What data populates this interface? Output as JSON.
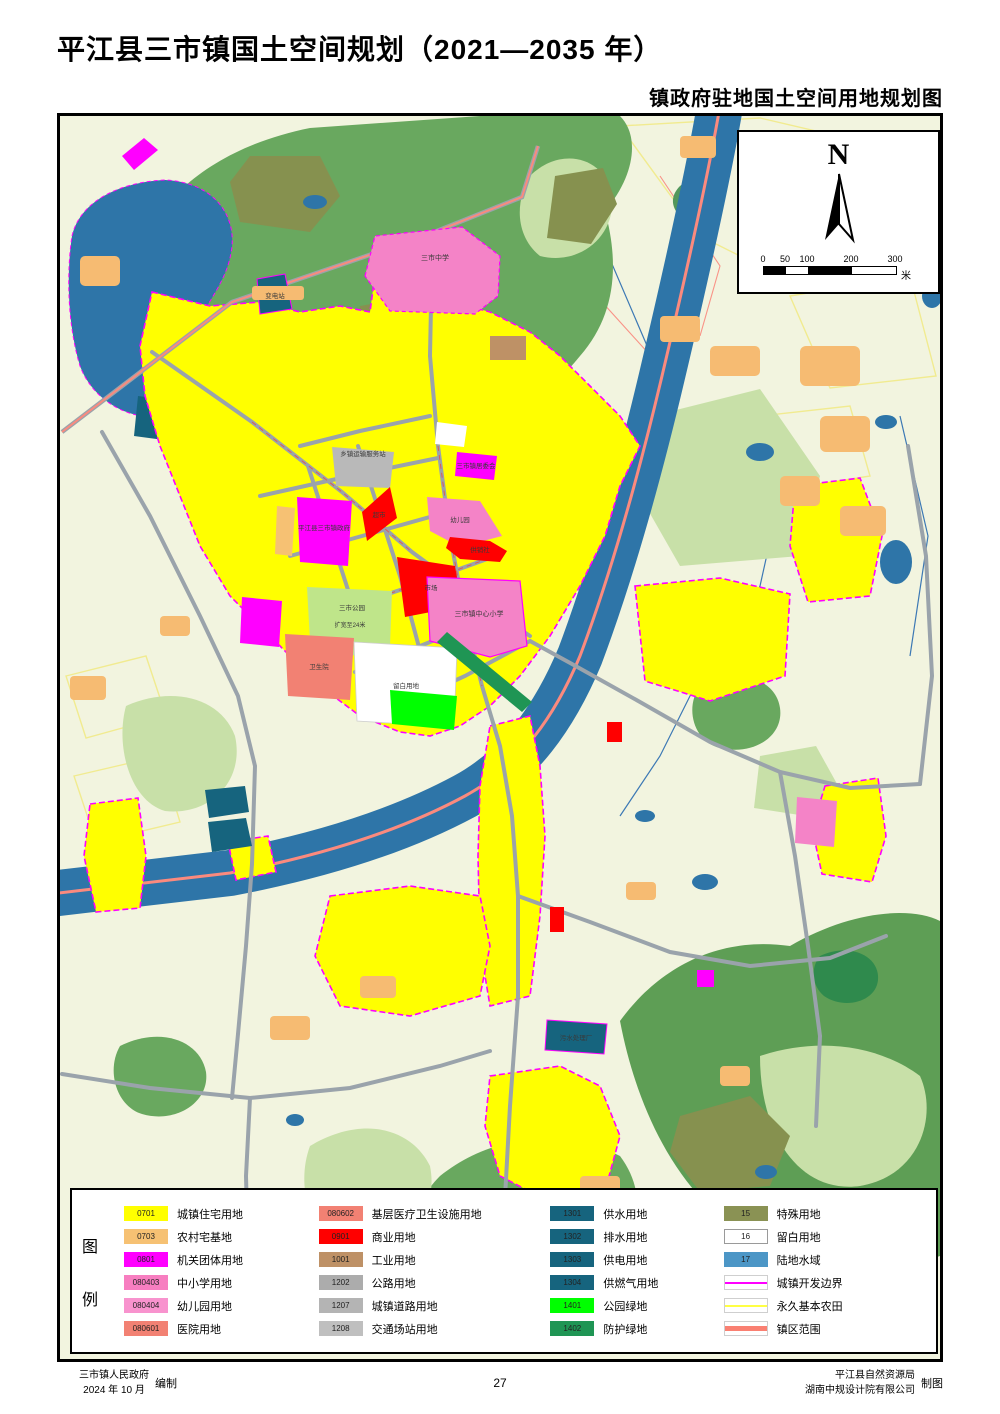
{
  "title": "平江县三市镇国土空间规划（2021—2035 年）",
  "subtitle": "镇政府驻地国土空间用地规划图",
  "map": {
    "north_label": "N",
    "scale": {
      "ticks": [
        "0",
        "50",
        "100",
        "200",
        "300"
      ],
      "tick_pos": [
        0,
        22,
        44,
        88,
        132
      ],
      "unit": "米"
    },
    "labels": [
      {
        "text": "三市中学",
        "x": 375,
        "y": 144,
        "size": 7
      },
      {
        "text": "变电站",
        "x": 215,
        "y": 182,
        "size": 6.5
      },
      {
        "text": "乡镇运输服务站",
        "x": 303,
        "y": 340,
        "size": 6.5
      },
      {
        "text": "三市镇居委会",
        "x": 416,
        "y": 352,
        "size": 6.5
      },
      {
        "text": "超市",
        "x": 319,
        "y": 401,
        "size": 6.5
      },
      {
        "text": "平江县三市镇政府",
        "x": 264,
        "y": 414,
        "size": 6.5
      },
      {
        "text": "幼儿园",
        "x": 400,
        "y": 406,
        "size": 6.5
      },
      {
        "text": "供销社",
        "x": 420,
        "y": 436,
        "size": 6.5
      },
      {
        "text": "市场",
        "x": 371,
        "y": 474,
        "size": 6.5
      },
      {
        "text": "三市公园",
        "x": 292,
        "y": 494,
        "size": 6.5
      },
      {
        "text": "扩宽至24米",
        "x": 290,
        "y": 511,
        "size": 6
      },
      {
        "text": "卫生院",
        "x": 259,
        "y": 553,
        "size": 6.5
      },
      {
        "text": "留白用地",
        "x": 346,
        "y": 572,
        "size": 6.5
      },
      {
        "text": "三市镇中心小学",
        "x": 419,
        "y": 500,
        "size": 7
      },
      {
        "text": "污水处理厂",
        "x": 516,
        "y": 924,
        "size": 6.5
      }
    ]
  },
  "legend": {
    "caption": [
      "图",
      "例"
    ],
    "columns": [
      {
        "items": [
          {
            "code": "0701",
            "label": "城镇住宅用地",
            "color": "#FFFF00"
          },
          {
            "code": "0703",
            "label": "农村宅基地",
            "color": "#F6C173"
          },
          {
            "code": "0801",
            "label": "机关团体用地",
            "color": "#FF00FF"
          },
          {
            "code": "080403",
            "label": "中小学用地",
            "color": "#F77EC0"
          },
          {
            "code": "080404",
            "label": "幼儿园用地",
            "color": "#F893CE"
          },
          {
            "code": "080601",
            "label": "医院用地",
            "color": "#F28173"
          }
        ]
      },
      {
        "items": [
          {
            "code": "080602",
            "label": "基层医疗卫生设施用地",
            "color": "#F28173"
          },
          {
            "code": "0901",
            "label": "商业用地",
            "color": "#FF0000"
          },
          {
            "code": "1001",
            "label": "工业用地",
            "color": "#BE9166"
          },
          {
            "code": "1202",
            "label": "公路用地",
            "color": "#ACACAC"
          },
          {
            "code": "1207",
            "label": "城镇道路用地",
            "color": "#B4B4B4"
          },
          {
            "code": "1208",
            "label": "交通场站用地",
            "color": "#BFBFBF"
          }
        ]
      },
      {
        "items": [
          {
            "code": "1301",
            "label": "供水用地",
            "color": "#16647E"
          },
          {
            "code": "1302",
            "label": "排水用地",
            "color": "#16647E"
          },
          {
            "code": "1303",
            "label": "供电用地",
            "color": "#16647E"
          },
          {
            "code": "1304",
            "label": "供燃气用地",
            "color": "#16647E"
          },
          {
            "code": "1401",
            "label": "公园绿地",
            "color": "#00FF00"
          },
          {
            "code": "1402",
            "label": "防护绿地",
            "color": "#1F9554"
          }
        ]
      },
      {
        "items": [
          {
            "code": "15",
            "label": "特殊用地",
            "color": "#8A9254"
          },
          {
            "code": "16",
            "label": "留白用地",
            "color": "#FFFFFF",
            "border": true
          },
          {
            "code": "17",
            "label": "陆地水域",
            "color": "#4C96C6"
          },
          {
            "type": "line",
            "label": "城镇开发边界",
            "color": "#FF00FF",
            "thick": 2
          },
          {
            "type": "line",
            "label": "永久基本农田",
            "color": "#FFFF44",
            "thick": 2
          },
          {
            "type": "line",
            "label": "镇区范围",
            "color": "#FA8072",
            "thick": 5
          }
        ]
      }
    ]
  },
  "footer": {
    "left_org": "三市镇人民政府",
    "left_date": "2024 年 10 月",
    "left_role": "编制",
    "page_number": "27",
    "right_org1": "平江县自然资源局",
    "right_org2": "湖南中规设计院有限公司",
    "right_role": "制图"
  },
  "colors": {
    "farmland_bg": "#F2F4DF",
    "forest": "#69A85F",
    "light_green": "#C8E0A8",
    "olive": "#86914F",
    "river": "#2E75A8",
    "water": "#4C96C6",
    "urban_residential": "#FFFF00",
    "rural_homestead": "#F6C173",
    "government": "#FF00FF",
    "school": "#F77EC0",
    "hospital": "#F28173",
    "commercial": "#FF0000",
    "utilities": "#16647E",
    "park_green": "#00FF00",
    "protective_green": "#1F9554",
    "road_gray": "#9AA3AB",
    "boundary_urban": "#FF00FF",
    "boundary_farmland": "#FFFF44",
    "town_extent": "#FA8072"
  }
}
